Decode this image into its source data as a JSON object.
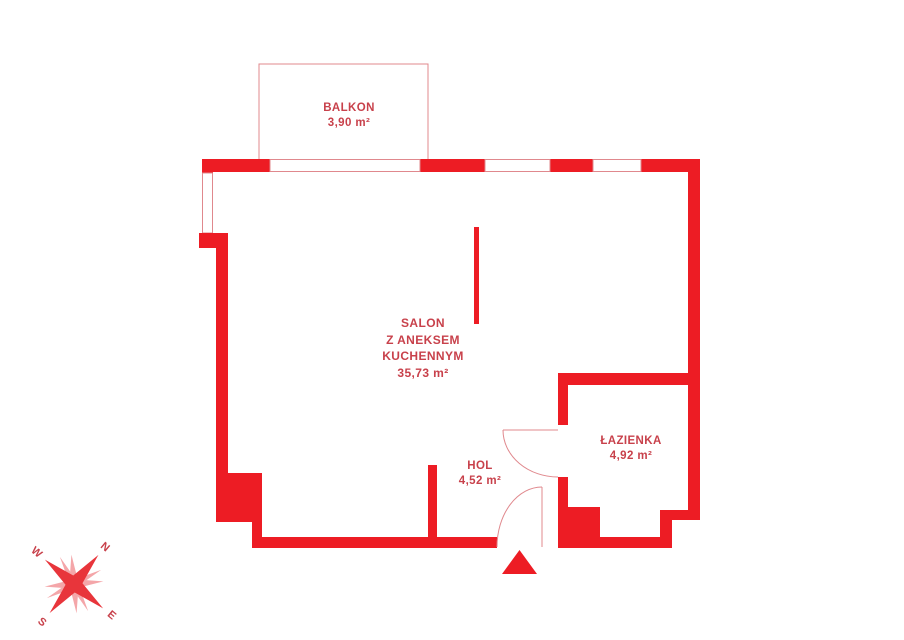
{
  "plan": {
    "balkon": {
      "name": "BALKON",
      "area": "3,90 m²"
    },
    "salon": {
      "line1": "SALON",
      "line2": "Z ANEKSEM",
      "line3": "KUCHENNYM",
      "area": "35,73 m²"
    },
    "hol": {
      "name": "HOL",
      "area": "4,52 m²"
    },
    "lazienka": {
      "name": "ŁAZIENKA",
      "area": "4,92 m²"
    }
  },
  "compass": {
    "n": "N",
    "e": "E",
    "s": "S",
    "w": "W"
  },
  "colors": {
    "wall_red": "#ed1c24",
    "label_text": "#c8414b",
    "thin_line": "#e0888d",
    "compass_light": "#f4a6a9"
  }
}
